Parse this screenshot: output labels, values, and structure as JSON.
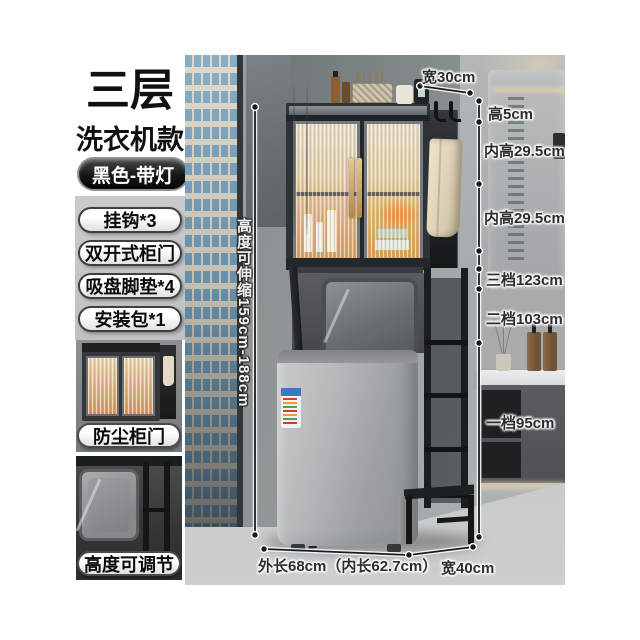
{
  "sidebar": {
    "title_line1": "三层",
    "title_line2": "洗衣机款",
    "variant_badge": "黑色-带灯",
    "features": [
      "挂钩*3",
      "双开式柜门",
      "吸盘脚垫*4",
      "安装包*1"
    ],
    "thumbnails": [
      {
        "caption": "防尘柜门"
      },
      {
        "caption": "高度可调节"
      }
    ]
  },
  "annotations": {
    "top_width": "宽30cm",
    "top_height": "高5cm",
    "inner_height_upper": "内高29.5cm",
    "inner_height_lower": "内高29.5cm",
    "gear_3": "三档123cm",
    "gear_2": "二档103cm",
    "gear_1": "一档95cm",
    "height_range_vertical": "高度可伸缩159cm-188cm",
    "outer_length": "外长68cm（内长62.7cm）",
    "bottom_depth": "宽40cm"
  },
  "colors": {
    "badge_bg": "#141516",
    "pill_border": "#3f3f3f",
    "handle_gold": "#caa55c",
    "cabinet_glow": "#dfa763",
    "label_text": "#2d2d2d"
  }
}
